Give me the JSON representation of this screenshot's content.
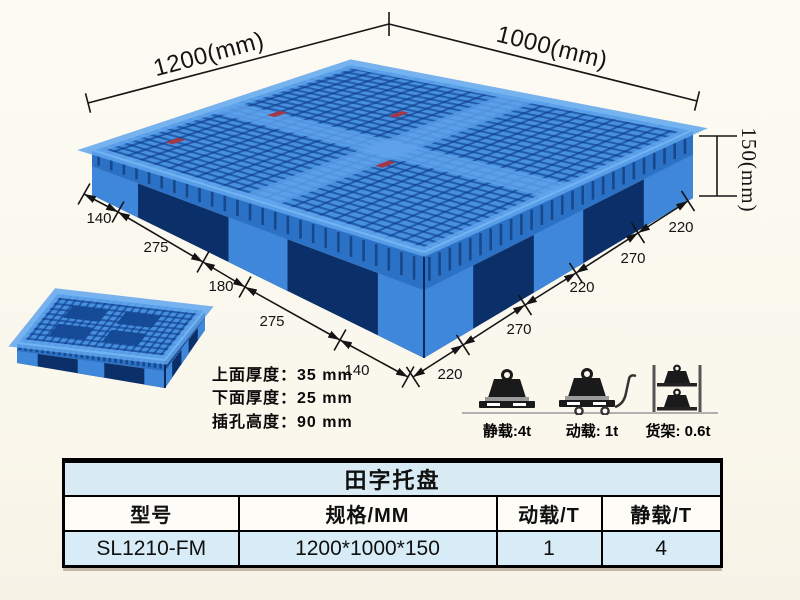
{
  "illustration": {
    "dim_width_label": "1200(mm)",
    "dim_depth_label": "1000(mm)",
    "dim_height_label": "150(mm)",
    "left_edge_segments": [
      "140",
      "275",
      "180",
      "275",
      "140"
    ],
    "right_edge_segments": [
      "220",
      "270",
      "220",
      "270",
      "220"
    ]
  },
  "thickness_notes": [
    "上面厚度：35 mm",
    "下面厚度：25 mm",
    "插孔高度：90 mm"
  ],
  "load_ratings": [
    {
      "icon": "static-load-icon",
      "label": "静载:4t"
    },
    {
      "icon": "dynamic-load-icon",
      "label": "动载: 1t"
    },
    {
      "icon": "rack-load-icon",
      "label": "货架: 0.6t"
    }
  ],
  "spec_table": {
    "title": "田字托盘",
    "headers": [
      "型号",
      "规格/MM",
      "动载/T",
      "静载/T"
    ],
    "rows": [
      [
        "SL1210-FM",
        "1200*1000*150",
        "1",
        "4"
      ]
    ]
  },
  "colors": {
    "pallet_blue": "#4690de",
    "pallet_dark_blue": "#0b2f68",
    "table_row_blue": "#d7ecf7",
    "background": "#fbf9ef"
  }
}
